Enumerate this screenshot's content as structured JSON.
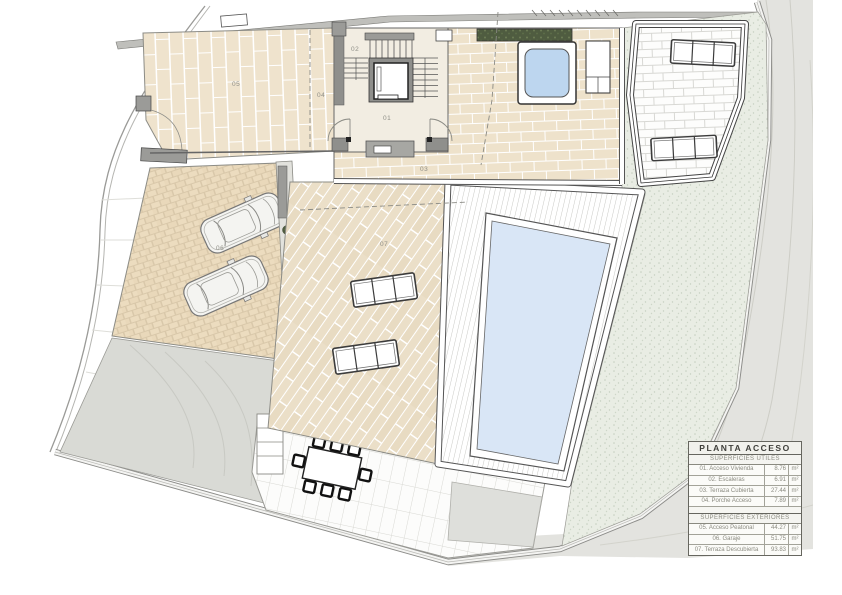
{
  "plan": {
    "zone_labels": {
      "z01": "01",
      "z02": "02",
      "z03": "03",
      "z04": "04",
      "z05": "05",
      "z06": "06",
      "z07": "07"
    }
  },
  "legend": {
    "title": "PLANTA ACCESO",
    "utiles_heading": "SUPERFICIES ÚTILES",
    "exteriores_heading": "SUPERFICIES EXTERIORES",
    "utiles_rows": [
      {
        "name": "01. Acceso Vivienda",
        "value": "8.76",
        "unit": "m²"
      },
      {
        "name": "02. Escaleras",
        "value": "6.91",
        "unit": "m²"
      },
      {
        "name": "03. Terraza Cubierta",
        "value": "27.44",
        "unit": "m²"
      },
      {
        "name": "04. Porche Acceso",
        "value": "7.89",
        "unit": "m²"
      }
    ],
    "exteriores_rows": [
      {
        "name": "05. Acceso Peatonal",
        "value": "44.27",
        "unit": "m²"
      },
      {
        "name": "06. Garaje",
        "value": "51.75",
        "unit": "m²"
      },
      {
        "name": "07. Terraza Descubierta",
        "value": "93.83",
        "unit": "m²"
      }
    ]
  },
  "colors": {
    "terrain": "#e3e3df",
    "garden": "#e9ede4",
    "pool_water": "#d9e6f6",
    "jacuzzi_water": "#bdd6ef",
    "tile_beige": "#efe3cd",
    "cobble": "#ecdcbf",
    "plank": "#ebdfc8",
    "driveway": "#d9dad5",
    "wall_gray": "#8f8f8c",
    "planter_green": "#4f5c40"
  }
}
